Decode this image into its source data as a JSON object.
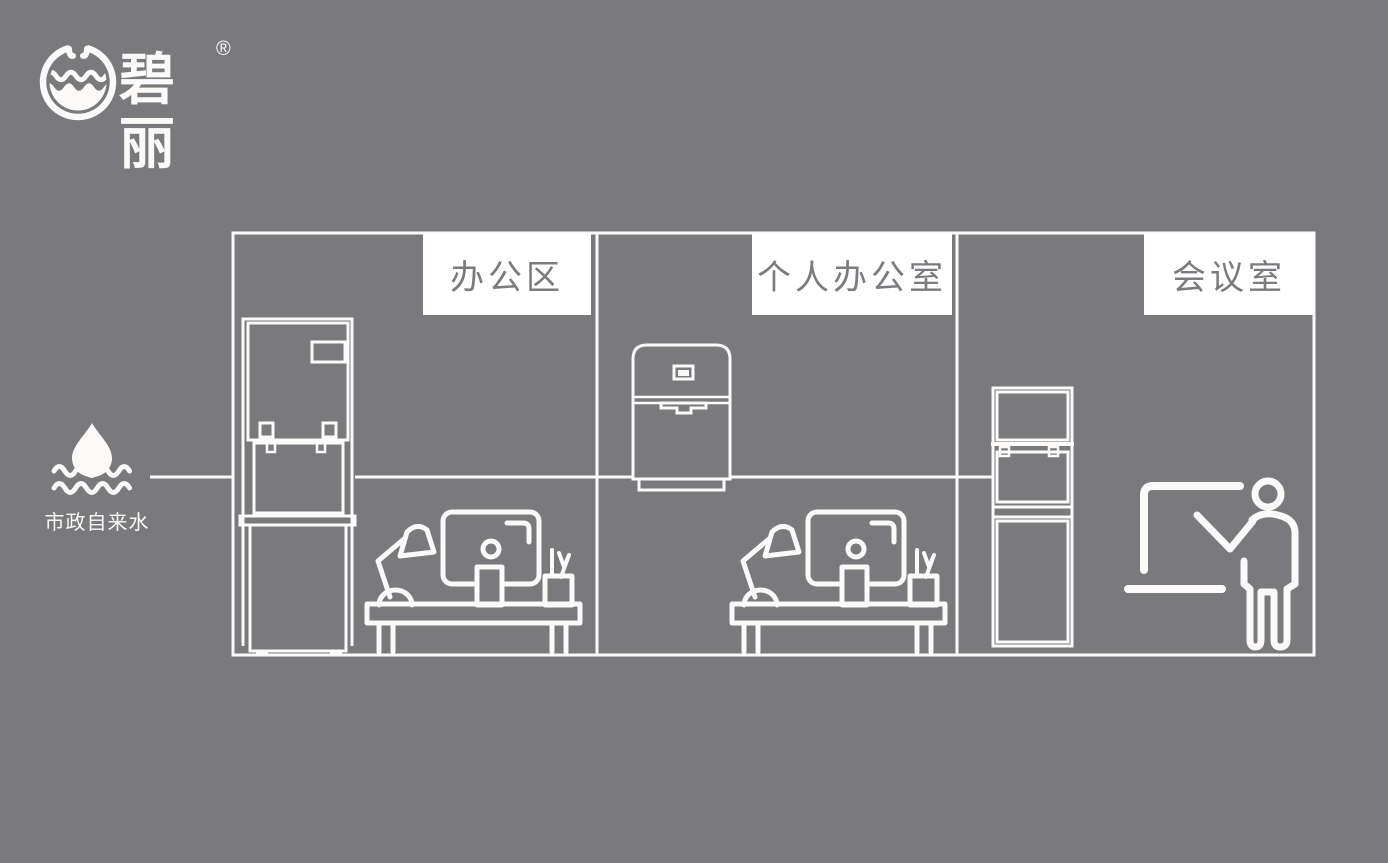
{
  "page": {
    "title": "碧丽饮水设备场景示意图",
    "background_color": "#7a797c",
    "line_color": "#fbfaf9"
  },
  "logo": {
    "brand_text": "碧丽",
    "registered_mark": "®",
    "icon": "water-cup-logo-icon"
  },
  "water_source": {
    "label": "市政自来水",
    "icons": [
      "water-drop-icon",
      "water-waves-icon"
    ]
  },
  "rooms": [
    {
      "label": "办公区",
      "equipment": [
        "floor-standing-water-dispenser",
        "office-desk-with-monitor-and-lamp"
      ]
    },
    {
      "label": "个人办公室",
      "equipment": [
        "countertop-water-dispenser",
        "office-desk-with-monitor-and-lamp"
      ]
    },
    {
      "label": "会议室",
      "equipment": [
        "upright-water-dispenser",
        "presenter-at-whiteboard"
      ]
    }
  ],
  "colors": {
    "background": "#7a797c",
    "line_art": "#fbfaf9",
    "label_background": "#ffffff",
    "label_text": "#7b7a7e"
  }
}
